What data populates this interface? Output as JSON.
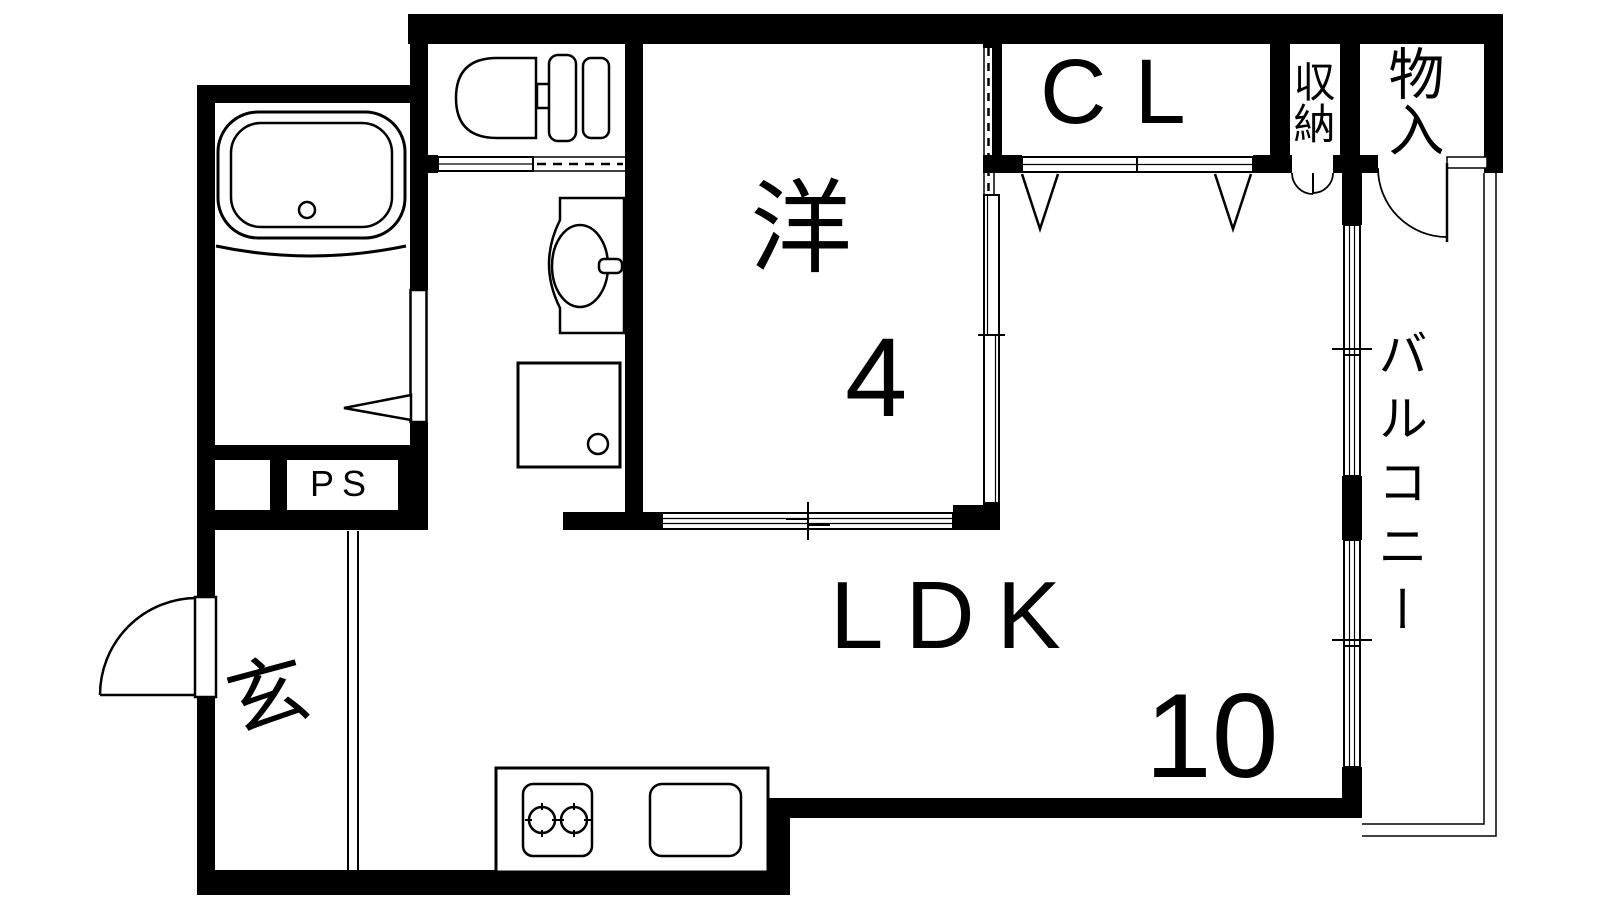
{
  "rooms": {
    "western_room": {
      "label": "洋",
      "size": "4"
    },
    "ldk": {
      "label": "LDK",
      "size": "10"
    },
    "closet": {
      "label": "CL"
    },
    "storage": {
      "label": "収納"
    },
    "closet2": {
      "label": "物入"
    },
    "balcony": {
      "label": "バルコニー"
    },
    "entrance": {
      "label": "玄"
    },
    "pipe_space": {
      "label": "PS"
    }
  },
  "fixtures": [
    "bathtub",
    "toilet",
    "washbasin",
    "washing-machine-pan",
    "gas-stove",
    "kitchen-sink",
    "entry-door",
    "bathroom-folding-door",
    "toilet-sliding-door",
    "closet-bifold-doors",
    "storage-double-doors",
    "storage-hinged-door",
    "balcony-sliding-windows"
  ],
  "colors": {
    "line": "#000000",
    "background": "#ffffff"
  }
}
